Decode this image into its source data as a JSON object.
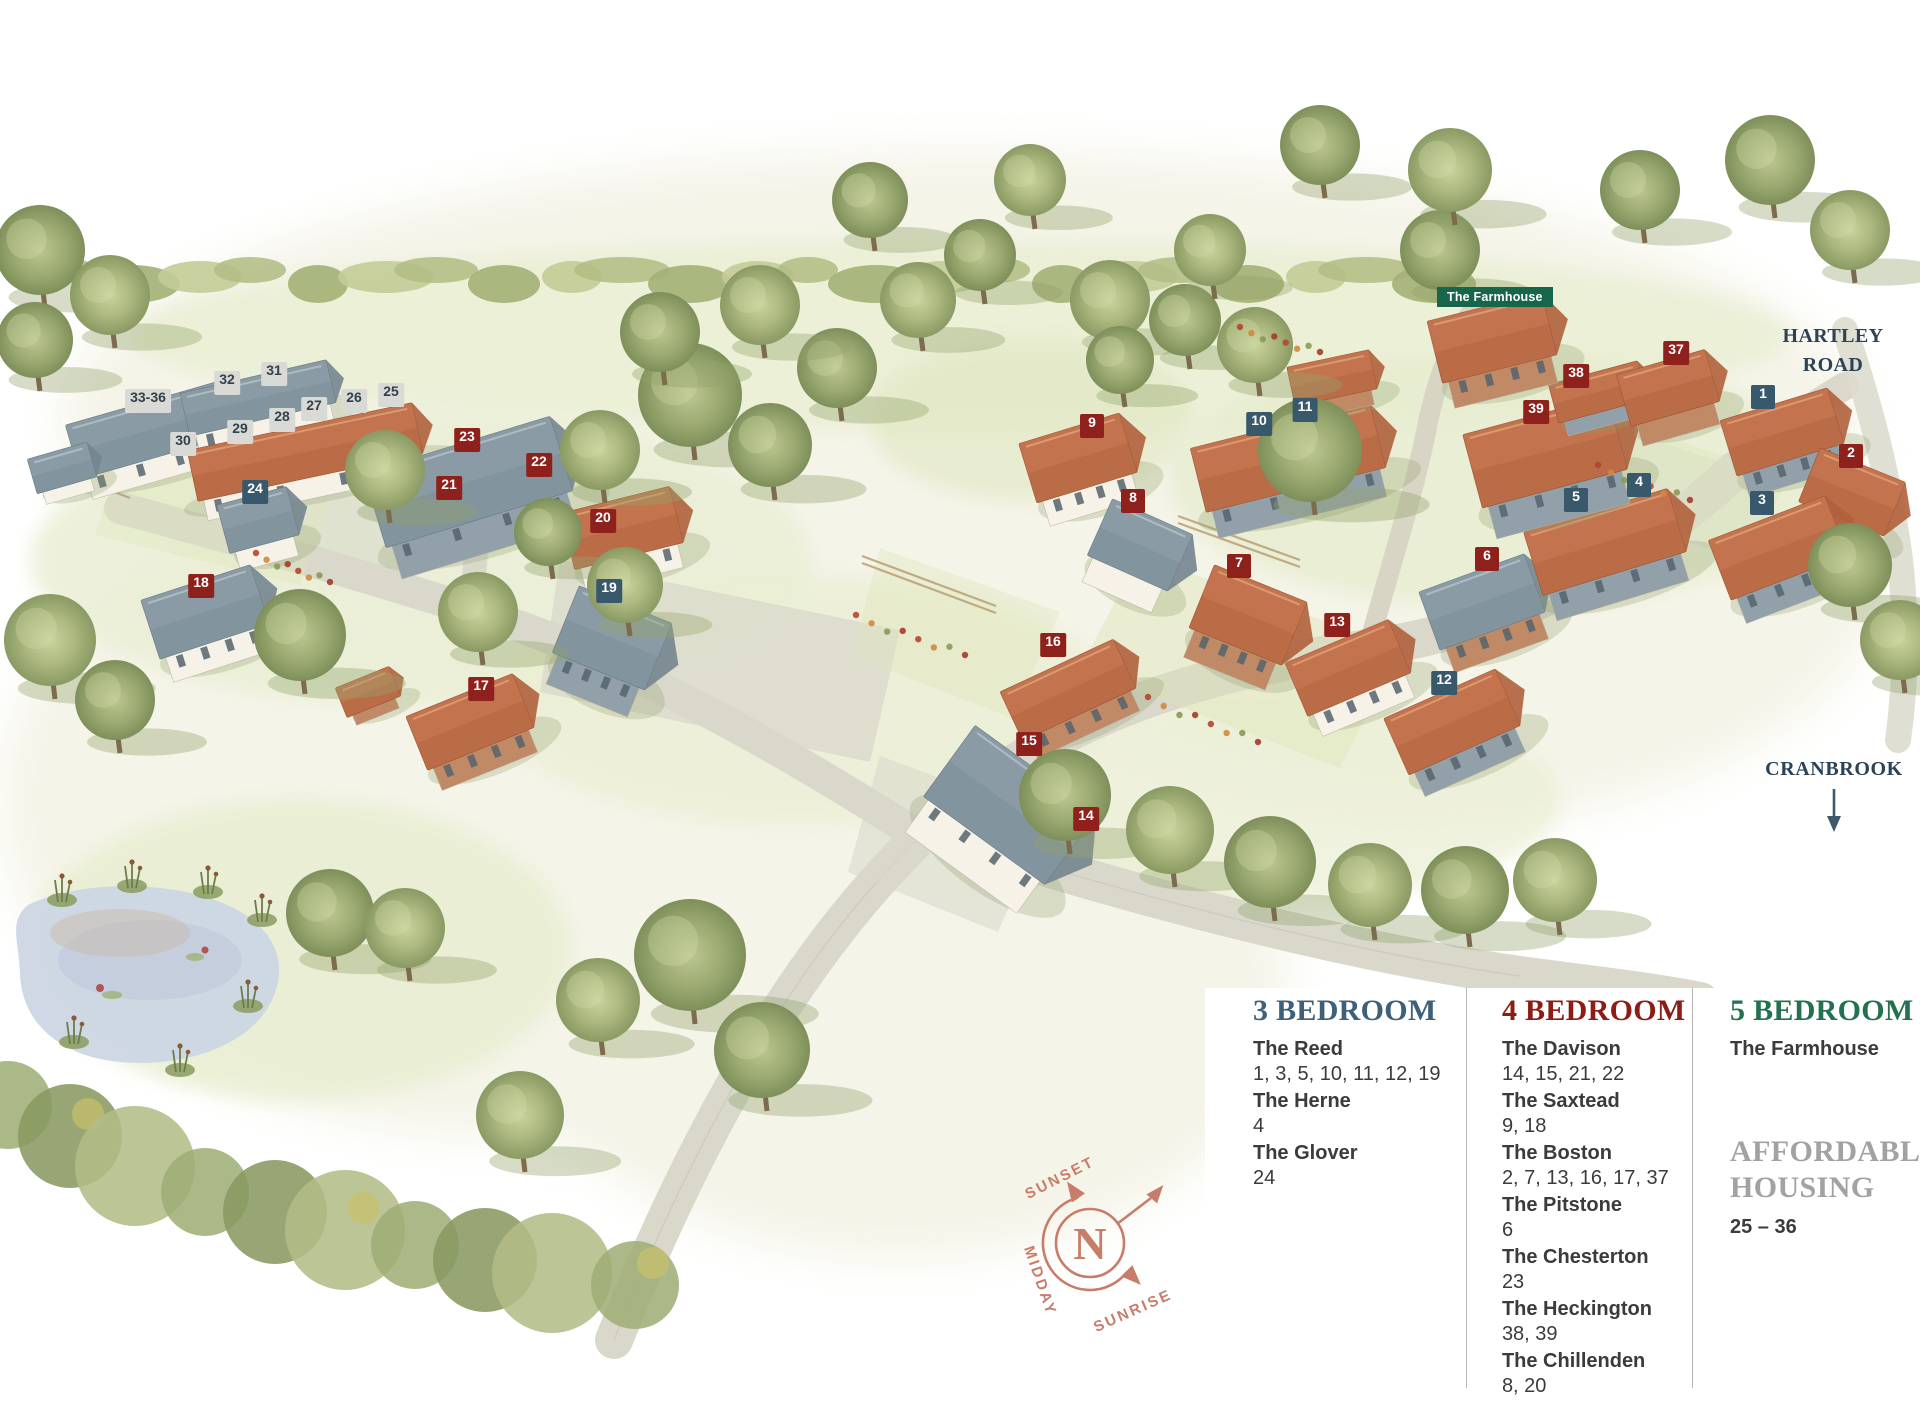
{
  "map": {
    "farmhouse_badge": "The Farmhouse",
    "road_label": "HARTLEY ROAD",
    "cranbrook_label": "CRANBROOK",
    "compass": {
      "n": "N",
      "sunset": "SUNSET",
      "sunrise": "SUNRISE",
      "midday": "MIDDAY"
    }
  },
  "colors": {
    "three_bed_marker": "#38596c",
    "four_bed_marker": "#8e211c",
    "affordable_marker_bg": "#d9dad5",
    "affordable_marker_text": "#31414d",
    "farmhouse_badge_bg": "#17654a",
    "road_label_text": "#2c4256",
    "compass_accent": "#c77d6a",
    "legend_3bed_heading": "#3f607a",
    "legend_4bed_heading": "#8d1d14",
    "legend_5bed_heading": "#23714f",
    "legend_affordable_heading": "#a2a2a2"
  },
  "markers": [
    {
      "label": "1",
      "type": "three_bed",
      "x": 1763,
      "y": 397
    },
    {
      "label": "2",
      "type": "four_bed",
      "x": 1851,
      "y": 456
    },
    {
      "label": "3",
      "type": "three_bed",
      "x": 1762,
      "y": 503
    },
    {
      "label": "4",
      "type": "three_bed",
      "x": 1639,
      "y": 485
    },
    {
      "label": "5",
      "type": "three_bed",
      "x": 1576,
      "y": 500
    },
    {
      "label": "6",
      "type": "four_bed",
      "x": 1487,
      "y": 559
    },
    {
      "label": "7",
      "type": "four_bed",
      "x": 1239,
      "y": 566
    },
    {
      "label": "8",
      "type": "four_bed",
      "x": 1133,
      "y": 501
    },
    {
      "label": "9",
      "type": "four_bed",
      "x": 1092,
      "y": 426
    },
    {
      "label": "10",
      "type": "three_bed",
      "x": 1259,
      "y": 424
    },
    {
      "label": "11",
      "type": "three_bed",
      "x": 1305,
      "y": 410
    },
    {
      "label": "12",
      "type": "three_bed",
      "x": 1444,
      "y": 683
    },
    {
      "label": "13",
      "type": "four_bed",
      "x": 1337,
      "y": 625
    },
    {
      "label": "14",
      "type": "four_bed",
      "x": 1086,
      "y": 819
    },
    {
      "label": "15",
      "type": "four_bed",
      "x": 1029,
      "y": 744
    },
    {
      "label": "16",
      "type": "four_bed",
      "x": 1053,
      "y": 645
    },
    {
      "label": "17",
      "type": "four_bed",
      "x": 481,
      "y": 689
    },
    {
      "label": "18",
      "type": "four_bed",
      "x": 201,
      "y": 586
    },
    {
      "label": "19",
      "type": "three_bed",
      "x": 609,
      "y": 591
    },
    {
      "label": "20",
      "type": "four_bed",
      "x": 603,
      "y": 521
    },
    {
      "label": "21",
      "type": "four_bed",
      "x": 449,
      "y": 488
    },
    {
      "label": "22",
      "type": "four_bed",
      "x": 539,
      "y": 465
    },
    {
      "label": "23",
      "type": "four_bed",
      "x": 467,
      "y": 440
    },
    {
      "label": "24",
      "type": "three_bed",
      "x": 255,
      "y": 492
    },
    {
      "label": "25",
      "type": "affordable",
      "x": 391,
      "y": 395
    },
    {
      "label": "26",
      "type": "affordable",
      "x": 354,
      "y": 401
    },
    {
      "label": "27",
      "type": "affordable",
      "x": 314,
      "y": 409
    },
    {
      "label": "28",
      "type": "affordable",
      "x": 282,
      "y": 420
    },
    {
      "label": "29",
      "type": "affordable",
      "x": 240,
      "y": 432
    },
    {
      "label": "30",
      "type": "affordable",
      "x": 183,
      "y": 444
    },
    {
      "label": "31",
      "type": "affordable",
      "x": 274,
      "y": 374
    },
    {
      "label": "32",
      "type": "affordable",
      "x": 227,
      "y": 383
    },
    {
      "label": "33-36",
      "type": "affordable",
      "x": 148,
      "y": 401
    },
    {
      "label": "37",
      "type": "four_bed",
      "x": 1676,
      "y": 353
    },
    {
      "label": "38",
      "type": "four_bed",
      "x": 1576,
      "y": 376
    },
    {
      "label": "39",
      "type": "four_bed",
      "x": 1536,
      "y": 412
    }
  ],
  "legend": {
    "columns": [
      {
        "heading": "3 BEDROOM",
        "color": "#3f607a",
        "items": [
          {
            "name": "The Reed",
            "plots": "1, 3, 5, 10, 11, 12, 19"
          },
          {
            "name": "The Herne",
            "plots": "4"
          },
          {
            "name": "The Glover",
            "plots": "24"
          }
        ]
      },
      {
        "heading": "4 BEDROOM",
        "color": "#8d1d14",
        "items": [
          {
            "name": "The Davison",
            "plots": "14, 15, 21, 22"
          },
          {
            "name": "The Saxtead",
            "plots": "9, 18"
          },
          {
            "name": "The Boston",
            "plots": "2, 7, 13, 16, 17, 37"
          },
          {
            "name": "The Pitstone",
            "plots": "6"
          },
          {
            "name": "The Chesterton",
            "plots": "23"
          },
          {
            "name": "The Heckington",
            "plots": "38, 39"
          },
          {
            "name": "The Chillenden",
            "plots": "8, 20"
          }
        ]
      },
      {
        "heading": "5 BEDROOM",
        "color": "#23714f",
        "items": [
          {
            "name": "The Farmhouse",
            "plots": ""
          }
        ]
      }
    ],
    "affordable": {
      "heading": "AFFORDABLE HOUSING",
      "plots": "25 – 36"
    }
  }
}
